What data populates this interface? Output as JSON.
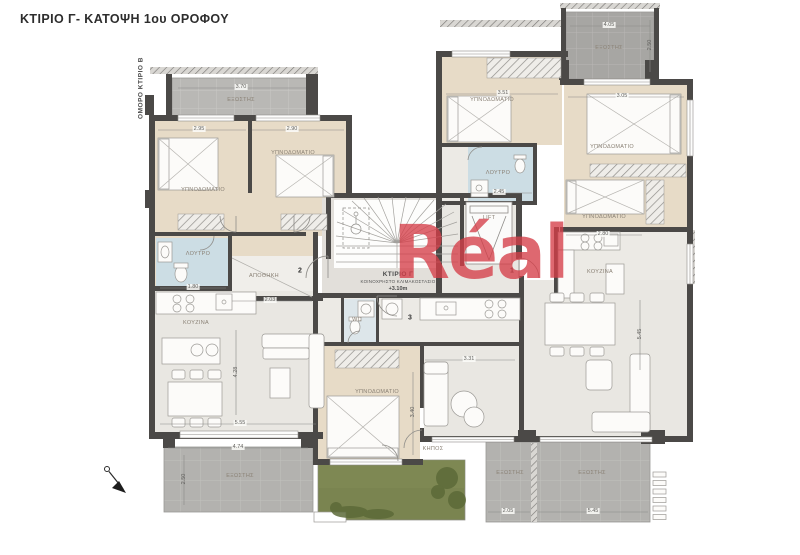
{
  "page": {
    "title": "ΚΤΙΡΙΟ Γ- ΚΑΤΟΨΗ 1ου ΟΡΟΦΟΥ",
    "side_label": "ΟΜΟΡΟ ΚΤΙΡΙΟ Β",
    "watermark": "Réal"
  },
  "core": {
    "building_label": "ΚΤΙΡΙΟ Γ",
    "core_sub": "ΚΟΙΝΟΧΡΗΣΤΟ ΚΛΙΜΑΚΟΣΤΑΣΙΟ",
    "level": "+3.10m",
    "lift": "LIFT"
  },
  "labels": {
    "rooms": [
      {
        "t": "ΕΞΩΣΤΗΣ",
        "x": 241,
        "y": 100
      },
      {
        "t": "ΥΠΝΟΔΩΜΑΤΙΟ",
        "x": 203,
        "y": 190
      },
      {
        "t": "ΥΠΝΟΔΩΜΑΤΙΟ",
        "x": 293,
        "y": 153
      },
      {
        "t": "ΛΟΥΤΡΟ",
        "x": 198,
        "y": 254
      },
      {
        "t": "ΑΠΟΘΗΚΗ",
        "x": 264,
        "y": 276
      },
      {
        "t": "ΚΟΥΖΙΝΑ",
        "x": 196,
        "y": 323
      },
      {
        "t": "ΥΠΝΟΔΩΜΑΤΙΟ",
        "x": 492,
        "y": 100
      },
      {
        "t": "ΛΟΥΤΡΟ",
        "x": 498,
        "y": 173
      },
      {
        "t": "ΕΞΩΣΤΗΣ",
        "x": 609,
        "y": 48
      },
      {
        "t": "ΥΠΝΟΔΩΜΑΤΙΟ",
        "x": 612,
        "y": 147
      },
      {
        "t": "ΥΠΝΟΔΩΜΑΤΙΟ",
        "x": 604,
        "y": 217
      },
      {
        "t": "ΚΟΥΖΙΝΑ",
        "x": 600,
        "y": 272
      },
      {
        "t": "WC",
        "x": 357,
        "y": 320
      },
      {
        "t": "ΥΠΝΟΔΩΜΑΤΙΟ",
        "x": 377,
        "y": 392
      },
      {
        "t": "ΚΗΠΟΣ",
        "x": 433,
        "y": 449
      },
      {
        "t": "ΕΞΩΣΤΗΣ",
        "x": 240,
        "y": 476
      },
      {
        "t": "ΕΞΩΣΤΗΣ",
        "x": 510,
        "y": 473
      },
      {
        "t": "ΕΞΩΣΤΗΣ",
        "x": 592,
        "y": 473
      },
      {
        "t": "LIFT",
        "x": 489,
        "y": 218
      }
    ],
    "dimensions": [
      {
        "t": "3.70",
        "x": 241,
        "y": 87
      },
      {
        "t": "2.95",
        "x": 199,
        "y": 129
      },
      {
        "t": "2.90",
        "x": 292,
        "y": 129
      },
      {
        "t": "3.51",
        "x": 503,
        "y": 93
      },
      {
        "t": "3.05",
        "x": 622,
        "y": 96
      },
      {
        "t": "4.05",
        "x": 609,
        "y": 25
      },
      {
        "t": "2.50",
        "x": 650,
        "y": 45,
        "v": true
      },
      {
        "t": "2.45",
        "x": 499,
        "y": 192
      },
      {
        "t": "1.80",
        "x": 193,
        "y": 287
      },
      {
        "t": "2.03",
        "x": 270,
        "y": 300
      },
      {
        "t": "2.80",
        "x": 603,
        "y": 234
      },
      {
        "t": "5.55",
        "x": 240,
        "y": 423
      },
      {
        "t": "4.28",
        "x": 236,
        "y": 372,
        "v": true
      },
      {
        "t": "4.74",
        "x": 238,
        "y": 447
      },
      {
        "t": "2.50",
        "x": 184,
        "y": 479,
        "v": true
      },
      {
        "t": "3.31",
        "x": 469,
        "y": 359
      },
      {
        "t": "3.40",
        "x": 413,
        "y": 412,
        "v": true
      },
      {
        "t": "5.45",
        "x": 640,
        "y": 334,
        "v": true
      },
      {
        "t": "2.05",
        "x": 508,
        "y": 511
      },
      {
        "t": "5.45",
        "x": 593,
        "y": 511
      }
    ],
    "unit_numbers": [
      {
        "t": "2",
        "x": 300,
        "y": 271
      },
      {
        "t": "1",
        "x": 512,
        "y": 271
      },
      {
        "t": "3",
        "x": 410,
        "y": 318
      }
    ]
  },
  "colors": {
    "walls": "#4b4947",
    "bedroom_floor": "#e7dbc7",
    "living_floor": "#e9e7e2",
    "bath_floor": "#ccdde4",
    "balcony_light": "#b9b8b5",
    "balcony_dark": "#a7a6a3",
    "garden_green": "#7a8450",
    "watermark_red": "#d53e48"
  }
}
